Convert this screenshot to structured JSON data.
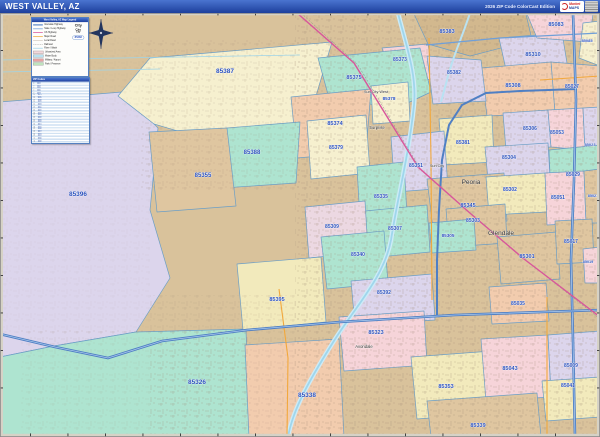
{
  "title_bar": {
    "title": "WEST VALLEY, AZ",
    "edition": "2026 ZIP Code ColorCast Edition",
    "logo_brand_top": "Market",
    "logo_brand_bottom": "MAPS"
  },
  "legend": {
    "header": "West Valley, AZ Map Legend",
    "items": [
      {
        "label": "Interstate Highway"
      },
      {
        "label": "State / Loop Highway"
      },
      {
        "label": "US Highway"
      },
      {
        "label": "Major Road"
      },
      {
        "label": "Local Road"
      },
      {
        "label": "Railroad"
      },
      {
        "label": "River / Wash"
      },
      {
        "label": "Urbanized Area"
      },
      {
        "label": "Water Body"
      },
      {
        "label": "Military / Airport"
      },
      {
        "label": "Park / Preserve"
      }
    ],
    "city_samples": [
      "City",
      "City",
      "City"
    ],
    "zip_code_sample": "85383"
  },
  "zip_table": {
    "header": "ZIP Codes",
    "zips": [
      "85009",
      "85017",
      "85019",
      "85021",
      "85023",
      "85027",
      "85029",
      "85035",
      "85041",
      "85043",
      "85051",
      "85053",
      "85083",
      "85085",
      "85301",
      "85302",
      "85303",
      "85304",
      "85305",
      "85306",
      "85307",
      "85308",
      "85309",
      "85310",
      "85323",
      "85326",
      "85335",
      "85338",
      "85339",
      "85340",
      "85345",
      "85351",
      "85353",
      "85355",
      "85373",
      "85374",
      "85375",
      "85378",
      "85379",
      "85381",
      "85382",
      "85383",
      "85387",
      "85388",
      "85392",
      "85395",
      "85396"
    ]
  },
  "map": {
    "cities": [
      {
        "name": "Sun City West",
        "x": 376,
        "y": 93,
        "fs": 3.8
      },
      {
        "name": "Surprise",
        "x": 377,
        "y": 129,
        "fs": 4.2
      },
      {
        "name": "Sun City",
        "x": 437,
        "y": 167,
        "fs": 3.8
      },
      {
        "name": "Peoria",
        "x": 471,
        "y": 184,
        "fs": 6.5
      },
      {
        "name": "Glendale",
        "x": 501,
        "y": 235,
        "fs": 6.5
      },
      {
        "name": "Avondale",
        "x": 364,
        "y": 348,
        "fs": 4.2
      }
    ],
    "zip_labels": [
      {
        "code": "85387",
        "x": 225,
        "y": 73,
        "fs": 6.5
      },
      {
        "code": "85383",
        "x": 447,
        "y": 33,
        "fs": 5.5
      },
      {
        "code": "85373",
        "x": 400,
        "y": 61,
        "fs": 5
      },
      {
        "code": "85310",
        "x": 533,
        "y": 56,
        "fs": 5.5
      },
      {
        "code": "85083",
        "x": 556,
        "y": 26,
        "fs": 5.5
      },
      {
        "code": "85085",
        "x": 587,
        "y": 42,
        "fs": 4
      },
      {
        "code": "85375",
        "x": 354,
        "y": 79,
        "fs": 5.5
      },
      {
        "code": "85382",
        "x": 454,
        "y": 74,
        "fs": 5
      },
      {
        "code": "85308",
        "x": 513,
        "y": 87,
        "fs": 5.5
      },
      {
        "code": "85027",
        "x": 572,
        "y": 88,
        "fs": 5
      },
      {
        "code": "85378",
        "x": 389,
        "y": 100,
        "fs": 4.6
      },
      {
        "code": "85374",
        "x": 335,
        "y": 125,
        "fs": 5.5
      },
      {
        "code": "85379",
        "x": 336,
        "y": 149,
        "fs": 5
      },
      {
        "code": "85388",
        "x": 252,
        "y": 154,
        "fs": 6
      },
      {
        "code": "85355",
        "x": 203,
        "y": 177,
        "fs": 6
      },
      {
        "code": "85396",
        "x": 78,
        "y": 196,
        "fs": 6.5
      },
      {
        "code": "85306",
        "x": 530,
        "y": 130,
        "fs": 5
      },
      {
        "code": "85053",
        "x": 557,
        "y": 134,
        "fs": 5
      },
      {
        "code": "85023",
        "x": 590,
        "y": 146,
        "fs": 4
      },
      {
        "code": "85381",
        "x": 463,
        "y": 144,
        "fs": 5
      },
      {
        "code": "85351",
        "x": 416,
        "y": 167,
        "fs": 5
      },
      {
        "code": "85304",
        "x": 509,
        "y": 159,
        "fs": 5
      },
      {
        "code": "85029",
        "x": 573,
        "y": 176,
        "fs": 5
      },
      {
        "code": "85335",
        "x": 381,
        "y": 198,
        "fs": 5
      },
      {
        "code": "85302",
        "x": 510,
        "y": 191,
        "fs": 5
      },
      {
        "code": "85051",
        "x": 558,
        "y": 199,
        "fs": 5
      },
      {
        "code": "85021",
        "x": 593,
        "y": 197,
        "fs": 3.8
      },
      {
        "code": "85345",
        "x": 468,
        "y": 207,
        "fs": 5.5
      },
      {
        "code": "85303",
        "x": 473,
        "y": 222,
        "fs": 5
      },
      {
        "code": "85307",
        "x": 395,
        "y": 230,
        "fs": 5
      },
      {
        "code": "85309",
        "x": 332,
        "y": 228,
        "fs": 5
      },
      {
        "code": "85305",
        "x": 448,
        "y": 237,
        "fs": 4.6
      },
      {
        "code": "85301",
        "x": 527,
        "y": 258,
        "fs": 5.5
      },
      {
        "code": "85017",
        "x": 571,
        "y": 243,
        "fs": 5
      },
      {
        "code": "85019",
        "x": 588,
        "y": 263,
        "fs": 3.8
      },
      {
        "code": "85340",
        "x": 358,
        "y": 256,
        "fs": 5
      },
      {
        "code": "85395",
        "x": 277,
        "y": 301,
        "fs": 5.5
      },
      {
        "code": "85392",
        "x": 384,
        "y": 294,
        "fs": 5
      },
      {
        "code": "85035",
        "x": 518,
        "y": 305,
        "fs": 5
      },
      {
        "code": "85323",
        "x": 376,
        "y": 334,
        "fs": 5.5
      },
      {
        "code": "85353",
        "x": 446,
        "y": 388,
        "fs": 5.5
      },
      {
        "code": "85043",
        "x": 510,
        "y": 370,
        "fs": 5.5
      },
      {
        "code": "85009",
        "x": 571,
        "y": 367,
        "fs": 5
      },
      {
        "code": "85041",
        "x": 568,
        "y": 387,
        "fs": 5
      },
      {
        "code": "85339",
        "x": 478,
        "y": 427,
        "fs": 5.5
      },
      {
        "code": "85338",
        "x": 307,
        "y": 397,
        "fs": 6.5
      },
      {
        "code": "85326",
        "x": 197,
        "y": 384,
        "fs": 6.5
      }
    ],
    "colors": {
      "freeway": "#4f7fc4",
      "us_highway": "#d8569b",
      "major_road": "#f2a83c",
      "river": "#9fd6ec",
      "zip_label": "#2b51bd",
      "title_bar": "#2450b4"
    }
  }
}
